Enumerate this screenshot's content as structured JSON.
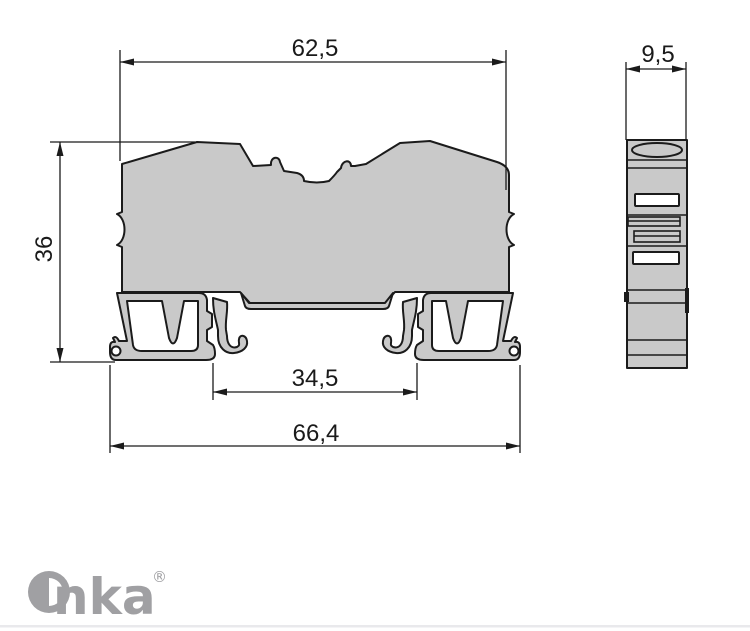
{
  "drawing": {
    "title": "DIN rail terminal block dimensional drawing",
    "views": {
      "front": "front-profile-view",
      "side": "side-view"
    },
    "dimensions": {
      "top_width": "62,5",
      "side_width": "9,5",
      "height": "36",
      "rail_opening": "34,5",
      "bottom_width": "66,4"
    },
    "colors": {
      "body_fill": "#c9c9c9",
      "outline": "#1b1b1b",
      "logo": "#a0a0a3",
      "divider": "#e9e9ec"
    }
  },
  "brand": {
    "name": "Onka",
    "wordmark_tail": "nka",
    "registered": "®"
  }
}
